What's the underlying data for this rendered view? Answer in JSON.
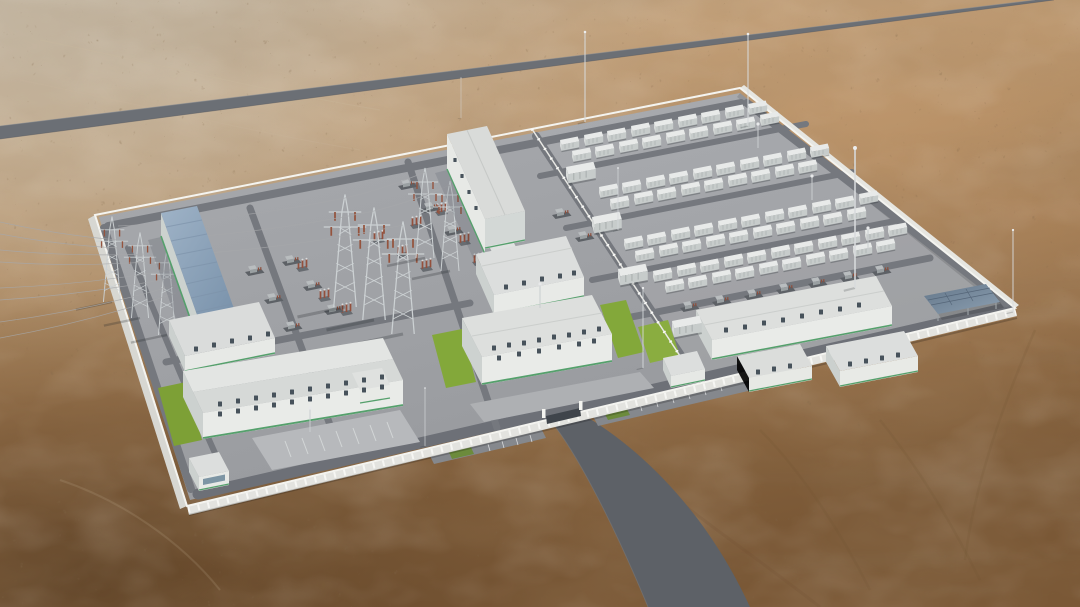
{
  "scene": {
    "type": "aerial-3d-render",
    "description": "Photorealistic aerial rendering of a desert energy complex: high-voltage substation yard with lattice towers and a blue-roofed hall on the left, battery energy storage container farm on the right, white perimeter wall, office buildings with lawns at the front, a gate with access road, and a diagonal highway across the desert above",
    "palette": {
      "desert_light": "#c9bba6",
      "desert_mid": "#b08a60",
      "desert_dark": "#6e4e2e",
      "highway": "#6b6f75",
      "internal_road": "#75787e",
      "pavement": "#a0a2a6",
      "perimeter_wall": "#efefeb",
      "building_wall": "#e9ebe8",
      "building_wall_shaded": "#ccd1cf",
      "roof_gray": "#dcdedd",
      "roof_blue": "#8ba1b8",
      "green_trim": "#55a06c",
      "lawn": "#83a83a",
      "container_white": "#e8eae9",
      "steel": "#ccd1d3",
      "solar_panel": "#69819a",
      "insulator_red": "#94503c"
    },
    "counts": {
      "battery_containers": 79,
      "container_bands": 4,
      "mv_stations": 4,
      "lattice_towers": 8,
      "lightning_masts": 8,
      "light_poles": 5,
      "buildings": 12
    },
    "instances": [
      {
        "name": "battery-container",
        "symbol": "sym-container",
        "layer": "layer-containers",
        "points": [
          [
            560,
            146
          ],
          [
            584,
            141
          ],
          [
            607,
            137
          ],
          [
            631,
            132
          ],
          [
            654,
            128
          ],
          [
            678,
            123
          ],
          [
            701,
            119
          ],
          [
            725,
            114
          ],
          [
            748,
            110
          ],
          [
            572,
            157
          ],
          [
            595,
            153
          ],
          [
            619,
            148
          ],
          [
            642,
            144
          ],
          [
            666,
            139
          ],
          [
            689,
            135
          ],
          [
            713,
            130
          ],
          [
            736,
            126
          ],
          [
            760,
            121
          ],
          [
            599,
            193
          ],
          [
            622,
            189
          ],
          [
            646,
            184
          ],
          [
            669,
            180
          ],
          [
            693,
            175
          ],
          [
            716,
            171
          ],
          [
            740,
            166
          ],
          [
            763,
            162
          ],
          [
            787,
            157
          ],
          [
            810,
            153
          ],
          [
            610,
            205
          ],
          [
            634,
            200
          ],
          [
            657,
            196
          ],
          [
            681,
            191
          ],
          [
            704,
            187
          ],
          [
            728,
            182
          ],
          [
            751,
            178
          ],
          [
            775,
            173
          ],
          [
            798,
            169
          ],
          [
            624,
            245
          ],
          [
            647,
            241
          ],
          [
            671,
            236
          ],
          [
            694,
            232
          ],
          [
            718,
            227
          ],
          [
            741,
            223
          ],
          [
            765,
            218
          ],
          [
            788,
            214
          ],
          [
            812,
            209
          ],
          [
            835,
            205
          ],
          [
            859,
            200
          ],
          [
            635,
            257
          ],
          [
            659,
            252
          ],
          [
            682,
            248
          ],
          [
            706,
            243
          ],
          [
            729,
            239
          ],
          [
            753,
            234
          ],
          [
            776,
            230
          ],
          [
            800,
            225
          ],
          [
            823,
            221
          ],
          [
            847,
            216
          ],
          [
            653,
            277
          ],
          [
            677,
            272
          ],
          [
            700,
            268
          ],
          [
            724,
            263
          ],
          [
            747,
            259
          ],
          [
            771,
            254
          ],
          [
            794,
            250
          ],
          [
            818,
            245
          ],
          [
            841,
            241
          ],
          [
            865,
            236
          ],
          [
            888,
            232
          ],
          [
            665,
            288
          ],
          [
            688,
            284
          ],
          [
            712,
            279
          ],
          [
            735,
            275
          ],
          [
            759,
            270
          ],
          [
            782,
            266
          ],
          [
            806,
            261
          ],
          [
            829,
            257
          ],
          [
            853,
            252
          ],
          [
            876,
            248
          ]
        ]
      },
      {
        "name": "mv-station-box",
        "symbol": "sym-bigbox",
        "layer": "layer-containers",
        "points": [
          [
            566,
            176
          ],
          [
            592,
            226
          ],
          [
            618,
            278
          ],
          [
            672,
            330
          ]
        ]
      },
      {
        "name": "lattice-tower",
        "symbol": "sym-tower",
        "layer": "layer-towers",
        "points": [
          [
            112,
            302,
            0.95
          ],
          [
            140,
            318,
            0.95
          ],
          [
            167,
            335,
            0.95
          ],
          [
            345,
            307,
            1.25
          ],
          [
            374,
            320,
            1.25
          ],
          [
            403,
            334,
            1.25
          ],
          [
            425,
            258,
            1
          ],
          [
            450,
            271,
            1
          ]
        ]
      },
      {
        "name": "insulator-stack",
        "symbol": "sym-redstack",
        "layer": "layer-equip",
        "points": [
          [
            318,
            298
          ],
          [
            340,
            312
          ],
          [
            296,
            268
          ],
          [
            372,
            240
          ],
          [
            396,
            254
          ],
          [
            420,
            268
          ],
          [
            410,
            225
          ],
          [
            435,
            212
          ],
          [
            458,
            242
          ],
          [
            472,
            262
          ]
        ]
      },
      {
        "name": "transformer-skid",
        "symbol": "sym-skid",
        "layer": "layer-equip",
        "points": [
          [
            282,
            262
          ],
          [
            303,
            287
          ],
          [
            324,
            311
          ],
          [
            398,
            186
          ],
          [
            421,
            209
          ],
          [
            444,
            232
          ],
          [
            552,
            215
          ],
          [
            575,
            238
          ],
          [
            245,
            272
          ],
          [
            264,
            300
          ],
          [
            283,
            328
          ]
        ]
      },
      {
        "name": "pcs-skid",
        "symbol": "sym-skid",
        "layer": "layer-equip",
        "points": [
          [
            680,
            308
          ],
          [
            712,
            302
          ],
          [
            744,
            296
          ],
          [
            776,
            290
          ],
          [
            808,
            284
          ],
          [
            840,
            278
          ],
          [
            872,
            272
          ]
        ]
      },
      {
        "name": "lightning-mast",
        "symbol": "sym-mast",
        "layer": "layer-masts",
        "points": [
          [
            585,
            122,
            0.9
          ],
          [
            748,
            126,
            0.92
          ],
          [
            855,
            288,
            1.4
          ],
          [
            1013,
            312,
            0.82
          ],
          [
            643,
            368,
            0.8
          ],
          [
            425,
            446,
            0.58
          ],
          [
            461,
            118,
            0.4
          ],
          [
            618,
            230,
            0.62
          ]
        ]
      },
      {
        "name": "light-pole",
        "symbol": "sym-pole",
        "layer": "layer-masts",
        "points": [
          [
            540,
            308
          ],
          [
            310,
            432
          ],
          [
            758,
            148
          ],
          [
            812,
            200
          ],
          [
            868,
            252
          ]
        ]
      },
      {
        "name": "window",
        "symbol": "sym-win",
        "layer": "layer-windows",
        "points": [
          [
            220,
            404
          ],
          [
            238,
            401
          ],
          [
            256,
            398
          ],
          [
            274,
            395
          ],
          [
            292,
            392
          ],
          [
            310,
            389
          ],
          [
            328,
            386
          ],
          [
            346,
            383
          ],
          [
            364,
            380
          ],
          [
            382,
            377
          ],
          [
            220,
            414
          ],
          [
            238,
            411
          ],
          [
            256,
            408
          ],
          [
            274,
            405
          ],
          [
            292,
            402
          ],
          [
            310,
            399
          ],
          [
            328,
            396
          ],
          [
            346,
            393
          ],
          [
            364,
            390
          ],
          [
            382,
            387
          ],
          [
            196,
            349
          ],
          [
            214,
            345
          ],
          [
            232,
            341
          ],
          [
            250,
            338
          ],
          [
            268,
            334
          ],
          [
            494,
            348
          ],
          [
            509,
            345
          ],
          [
            524,
            343
          ],
          [
            539,
            340
          ],
          [
            554,
            337
          ],
          [
            569,
            335
          ],
          [
            584,
            332
          ],
          [
            599,
            329
          ],
          [
            499,
            358
          ],
          [
            519,
            354
          ],
          [
            539,
            351
          ],
          [
            559,
            347
          ],
          [
            579,
            344
          ],
          [
            594,
            341
          ],
          [
            506,
            287
          ],
          [
            524,
            283
          ],
          [
            542,
            279
          ],
          [
            560,
            276
          ],
          [
            574,
            273
          ],
          [
            726,
            330
          ],
          [
            745,
            327
          ],
          [
            764,
            323
          ],
          [
            783,
            320
          ],
          [
            802,
            316
          ],
          [
            821,
            312
          ],
          [
            840,
            309
          ],
          [
            859,
            305
          ],
          [
            850,
            364
          ],
          [
            866,
            361
          ],
          [
            882,
            358
          ],
          [
            898,
            355
          ],
          [
            758,
            372
          ],
          [
            774,
            369
          ],
          [
            790,
            366
          ],
          [
            455,
            160,
            0.8
          ],
          [
            462,
            176,
            0.8
          ],
          [
            469,
            192,
            0.8
          ],
          [
            476,
            208,
            0.8
          ]
        ]
      },
      {
        "name": "transmission-wire",
        "type": "wire",
        "layer": "layer-wires",
        "paths": [
          [
            118,
            240,
            0,
            222,
            4
          ],
          [
            118,
            248,
            0,
            234,
            4
          ],
          [
            146,
            254,
            0,
            250,
            5
          ],
          [
            146,
            262,
            0,
            262,
            5
          ],
          [
            176,
            269,
            0,
            288,
            6
          ],
          [
            176,
            277,
            0,
            300,
            6
          ],
          [
            176,
            285,
            0,
            322,
            7
          ],
          [
            176,
            293,
            0,
            338,
            7
          ],
          [
            118,
            226,
            345,
            198,
            9
          ],
          [
            146,
            240,
            374,
            211,
            9
          ],
          [
            176,
            255,
            403,
            225,
            9
          ],
          [
            345,
            198,
            425,
            172,
            4
          ],
          [
            374,
            211,
            450,
            185,
            4
          ]
        ]
      }
    ]
  }
}
